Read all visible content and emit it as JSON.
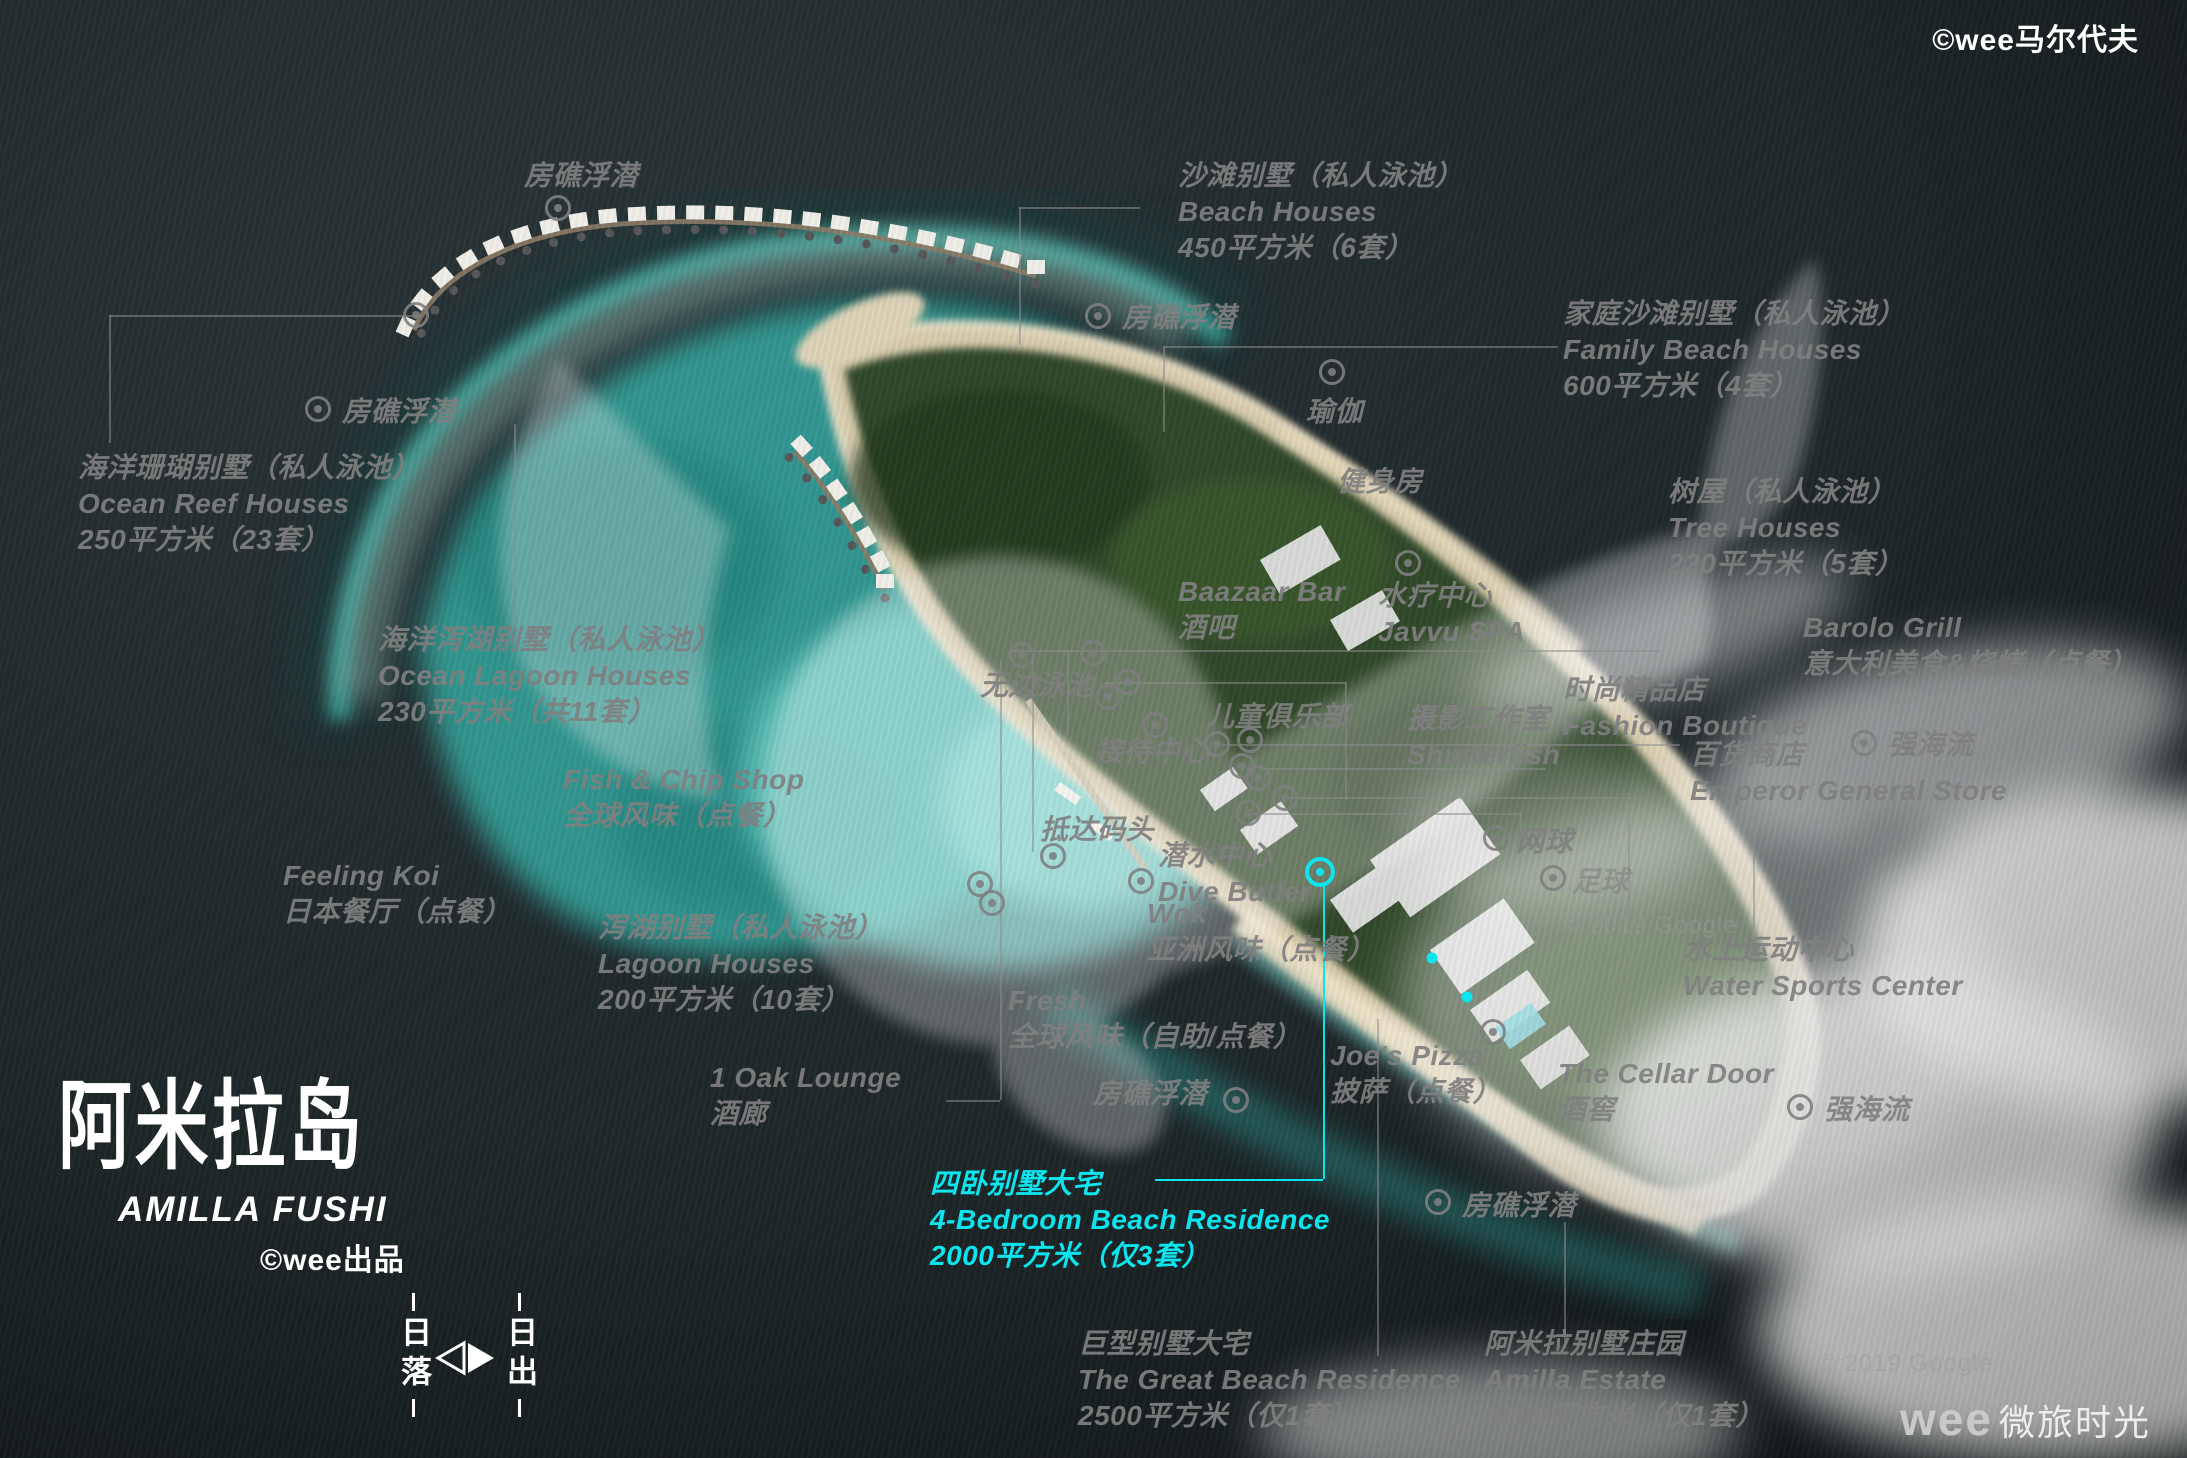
{
  "title": {
    "zh": "阿米拉岛",
    "en": "AMILLA FUSHI",
    "byline": "©wee出品"
  },
  "watermarks": {
    "top_right": "©wee马尔代夫",
    "bottom_right_wee": "wee",
    "bottom_right_brand": "微旅时光"
  },
  "compass": {
    "west": "日落",
    "east": "日出"
  },
  "colors": {
    "label_gray": "#7f7f7f",
    "highlight_cyan": "#0de4ee",
    "title_white": "#ffffff"
  },
  "labels": [
    {
      "id": "reef-snorkel-top",
      "x": 524,
      "y": 158,
      "lines": [
        "房礁浮潜"
      ]
    },
    {
      "id": "beach-houses",
      "x": 1178,
      "y": 158,
      "lines": [
        "沙滩别墅（私人泳池）",
        "Beach Houses",
        "450平方米（6套）"
      ]
    },
    {
      "id": "family-beach-houses",
      "x": 1563,
      "y": 296,
      "lines": [
        "家庭沙滩别墅（私人泳池）",
        "Family Beach Houses",
        "600平方米（4套）"
      ]
    },
    {
      "id": "reef-snorkel-left-mid",
      "x": 1122,
      "y": 300,
      "lines": [
        "房礁浮潜"
      ]
    },
    {
      "id": "yoga",
      "x": 1306,
      "y": 394,
      "lines": [
        "瑜伽"
      ]
    },
    {
      "id": "gym",
      "x": 1337,
      "y": 464,
      "lines": [
        "健身房"
      ]
    },
    {
      "id": "tree-houses",
      "x": 1668,
      "y": 474,
      "lines": [
        "树屋（私人泳池）",
        "Tree Houses",
        "220平方米（5套）"
      ]
    },
    {
      "id": "ocean-reef-houses",
      "x": 78,
      "y": 450,
      "lines": [
        "海洋珊瑚别墅（私人泳池）",
        "Ocean Reef Houses",
        "250平方米（23套）"
      ]
    },
    {
      "id": "reef-snorkel-far-left",
      "x": 342,
      "y": 394,
      "lines": [
        "房礁浮潜"
      ]
    },
    {
      "id": "baazaar-bar",
      "x": 1178,
      "y": 574,
      "lines": [
        "Baazaar Bar",
        "酒吧"
      ]
    },
    {
      "id": "javvu-spa",
      "x": 1378,
      "y": 578,
      "lines": [
        "水疗中心",
        "Javvu SPA"
      ]
    },
    {
      "id": "barolo-grill",
      "x": 1803,
      "y": 610,
      "lines": [
        "Barolo Grill",
        "意大利美食&烧烤（点餐）"
      ]
    },
    {
      "id": "ocean-lagoon-houses",
      "x": 378,
      "y": 622,
      "lines": [
        "海洋泻湖别墅（私人泳池）",
        "Ocean Lagoon Houses",
        "230平方米（共11套）"
      ]
    },
    {
      "id": "infinity-pool",
      "x": 980,
      "y": 668,
      "lines": [
        "无边泳池"
      ]
    },
    {
      "id": "fashion-boutique",
      "x": 1563,
      "y": 672,
      "lines": [
        "时尚精品店",
        "Fashion Boutique"
      ]
    },
    {
      "id": "kids-club",
      "x": 1206,
      "y": 699,
      "lines": [
        "儿童俱乐部"
      ]
    },
    {
      "id": "photo-studio",
      "x": 1407,
      "y": 701,
      "lines": [
        "摄影工作室",
        "Shutterfish"
      ]
    },
    {
      "id": "emperor-store",
      "x": 1690,
      "y": 737,
      "lines": [
        "百货商店",
        "Emperor General Store"
      ]
    },
    {
      "id": "strong-current-right",
      "x": 1888,
      "y": 727,
      "lines": [
        "强海流"
      ]
    },
    {
      "id": "reception",
      "x": 1095,
      "y": 734,
      "lines": [
        "接待中心"
      ]
    },
    {
      "id": "fish-chip-shop",
      "x": 563,
      "y": 762,
      "lines": [
        "Fish & Chip Shop",
        "全球风味（点餐）"
      ]
    },
    {
      "id": "arrival-jetty",
      "x": 1040,
      "y": 812,
      "lines": [
        "抵达码头"
      ]
    },
    {
      "id": "tennis",
      "x": 1516,
      "y": 824,
      "lines": [
        "网球"
      ]
    },
    {
      "id": "dive-butler",
      "x": 1158,
      "y": 838,
      "lines": [
        "潜水中心",
        "Dive Butler"
      ]
    },
    {
      "id": "feeling-koi",
      "x": 283,
      "y": 858,
      "lines": [
        "Feeling Koi",
        "日本餐厅（点餐）"
      ]
    },
    {
      "id": "soccer",
      "x": 1572,
      "y": 864,
      "lines": [
        "足球"
      ],
      "cls": "faint"
    },
    {
      "id": "wok",
      "x": 1147,
      "y": 896,
      "lines": [
        "Wok",
        "亚洲风味（点餐）"
      ]
    },
    {
      "id": "lagoon-houses",
      "x": 598,
      "y": 910,
      "lines": [
        "泻湖别墅（私人泳池）",
        "Lagoon Houses",
        "200平方米（10套）"
      ]
    },
    {
      "id": "google-credit-mid",
      "x": 1563,
      "y": 912,
      "lines": [
        "© 2019 Google"
      ],
      "cls": "google"
    },
    {
      "id": "water-sports-center",
      "x": 1683,
      "y": 932,
      "lines": [
        "水上运动中心",
        "Water Sports Center"
      ]
    },
    {
      "id": "fresh",
      "x": 1008,
      "y": 983,
      "lines": [
        "Fresh",
        "全球风味（自助/点餐）"
      ]
    },
    {
      "id": "joes-pizza",
      "x": 1330,
      "y": 1038,
      "lines": [
        "Joe's Pizza",
        "披萨（点餐）"
      ]
    },
    {
      "id": "cellar-door",
      "x": 1558,
      "y": 1056,
      "lines": [
        "The Cellar Door",
        "酒窖"
      ]
    },
    {
      "id": "oak-lounge",
      "x": 710,
      "y": 1060,
      "lines": [
        "1 Oak Lounge",
        "酒廊"
      ]
    },
    {
      "id": "reef-snorkel-mid-bottom",
      "x": 1093,
      "y": 1076,
      "lines": [
        "房礁浮潜"
      ]
    },
    {
      "id": "strong-current-bottom",
      "x": 1824,
      "y": 1092,
      "lines": [
        "强海流"
      ]
    },
    {
      "id": "residence-4br",
      "x": 930,
      "y": 1166,
      "lines": [
        "四卧别墅大宅",
        "4-Bedroom Beach Residence",
        "2000平方米（仅3套）"
      ],
      "cls": "cyan"
    },
    {
      "id": "reef-snorkel-bottom-right",
      "x": 1462,
      "y": 1188,
      "lines": [
        "房礁浮潜"
      ]
    },
    {
      "id": "great-beach-residence",
      "x": 1078,
      "y": 1326,
      "lines": [
        "巨型别墅大宅",
        "The Great Beach Residence",
        "2500平方米（仅1套）"
      ]
    },
    {
      "id": "amilla-estate",
      "x": 1484,
      "y": 1326,
      "lines": [
        "阿米拉别墅庄园",
        "Amilla Estate",
        "3000平方米（仅1套）"
      ]
    },
    {
      "id": "google-credit-bottom",
      "x": 1818,
      "y": 1350,
      "lines": [
        "© 2019 Google"
      ],
      "cls": "google"
    }
  ],
  "markers": [
    [
      558,
      208
    ],
    [
      416,
      315
    ],
    [
      318,
      409
    ],
    [
      1098,
      316
    ],
    [
      1332,
      372
    ],
    [
      1408,
      563
    ],
    [
      1022,
      655
    ],
    [
      1093,
      653
    ],
    [
      1128,
      682
    ],
    [
      1108,
      697
    ],
    [
      1155,
      725
    ],
    [
      1217,
      744
    ],
    [
      1250,
      740
    ],
    [
      1242,
      766
    ],
    [
      1258,
      778
    ],
    [
      1285,
      798
    ],
    [
      1248,
      813
    ],
    [
      1053,
      856
    ],
    [
      1141,
      881
    ],
    [
      980,
      884
    ],
    [
      992,
      903
    ],
    [
      1236,
      1100
    ],
    [
      1493,
      1032
    ],
    [
      1438,
      1202
    ],
    [
      1496,
      838
    ],
    [
      1553,
      878
    ],
    [
      1864,
      743
    ],
    [
      1800,
      1107
    ]
  ],
  "lines": [
    [
      1019,
      207,
      1019,
      345
    ],
    [
      1019,
      207,
      1140,
      207
    ],
    [
      1163,
      346,
      1163,
      432
    ],
    [
      1163,
      346,
      1558,
      346
    ],
    [
      109,
      315,
      109,
      443
    ],
    [
      109,
      315,
      420,
      315
    ],
    [
      514,
      424,
      514,
      628
    ],
    [
      1010,
      650,
      1660,
      650
    ],
    [
      1105,
      682,
      1345,
      682
    ],
    [
      1345,
      682,
      1345,
      800
    ],
    [
      1000,
      660,
      1000,
      1100
    ],
    [
      946,
      1100,
      1000,
      1100
    ],
    [
      1032,
      655,
      1032,
      852
    ],
    [
      1067,
      650,
      1067,
      735
    ],
    [
      1222,
      744,
      1680,
      744
    ],
    [
      1262,
      768,
      1546,
      768
    ],
    [
      1290,
      797,
      1646,
      797
    ],
    [
      1253,
      813,
      1520,
      813
    ],
    [
      1520,
      813,
      1520,
      832
    ],
    [
      1628,
      815,
      1628,
      1042
    ],
    [
      1753,
      815,
      1753,
      932
    ],
    [
      1377,
      1019,
      1377,
      1356
    ],
    [
      1564,
      1222,
      1564,
      1348
    ]
  ],
  "cyan": {
    "ring": [
      1320,
      872
    ],
    "dots": [
      [
        1432,
        958
      ],
      [
        1467,
        997
      ]
    ],
    "lines": [
      [
        1323,
        884,
        1323,
        1179
      ],
      [
        1155,
        1179,
        1323,
        1179
      ]
    ]
  },
  "scene": {
    "villa_rows": [
      {
        "path": "jettyA",
        "count": 24
      },
      {
        "path": "jettyC",
        "count": 7
      }
    ]
  }
}
